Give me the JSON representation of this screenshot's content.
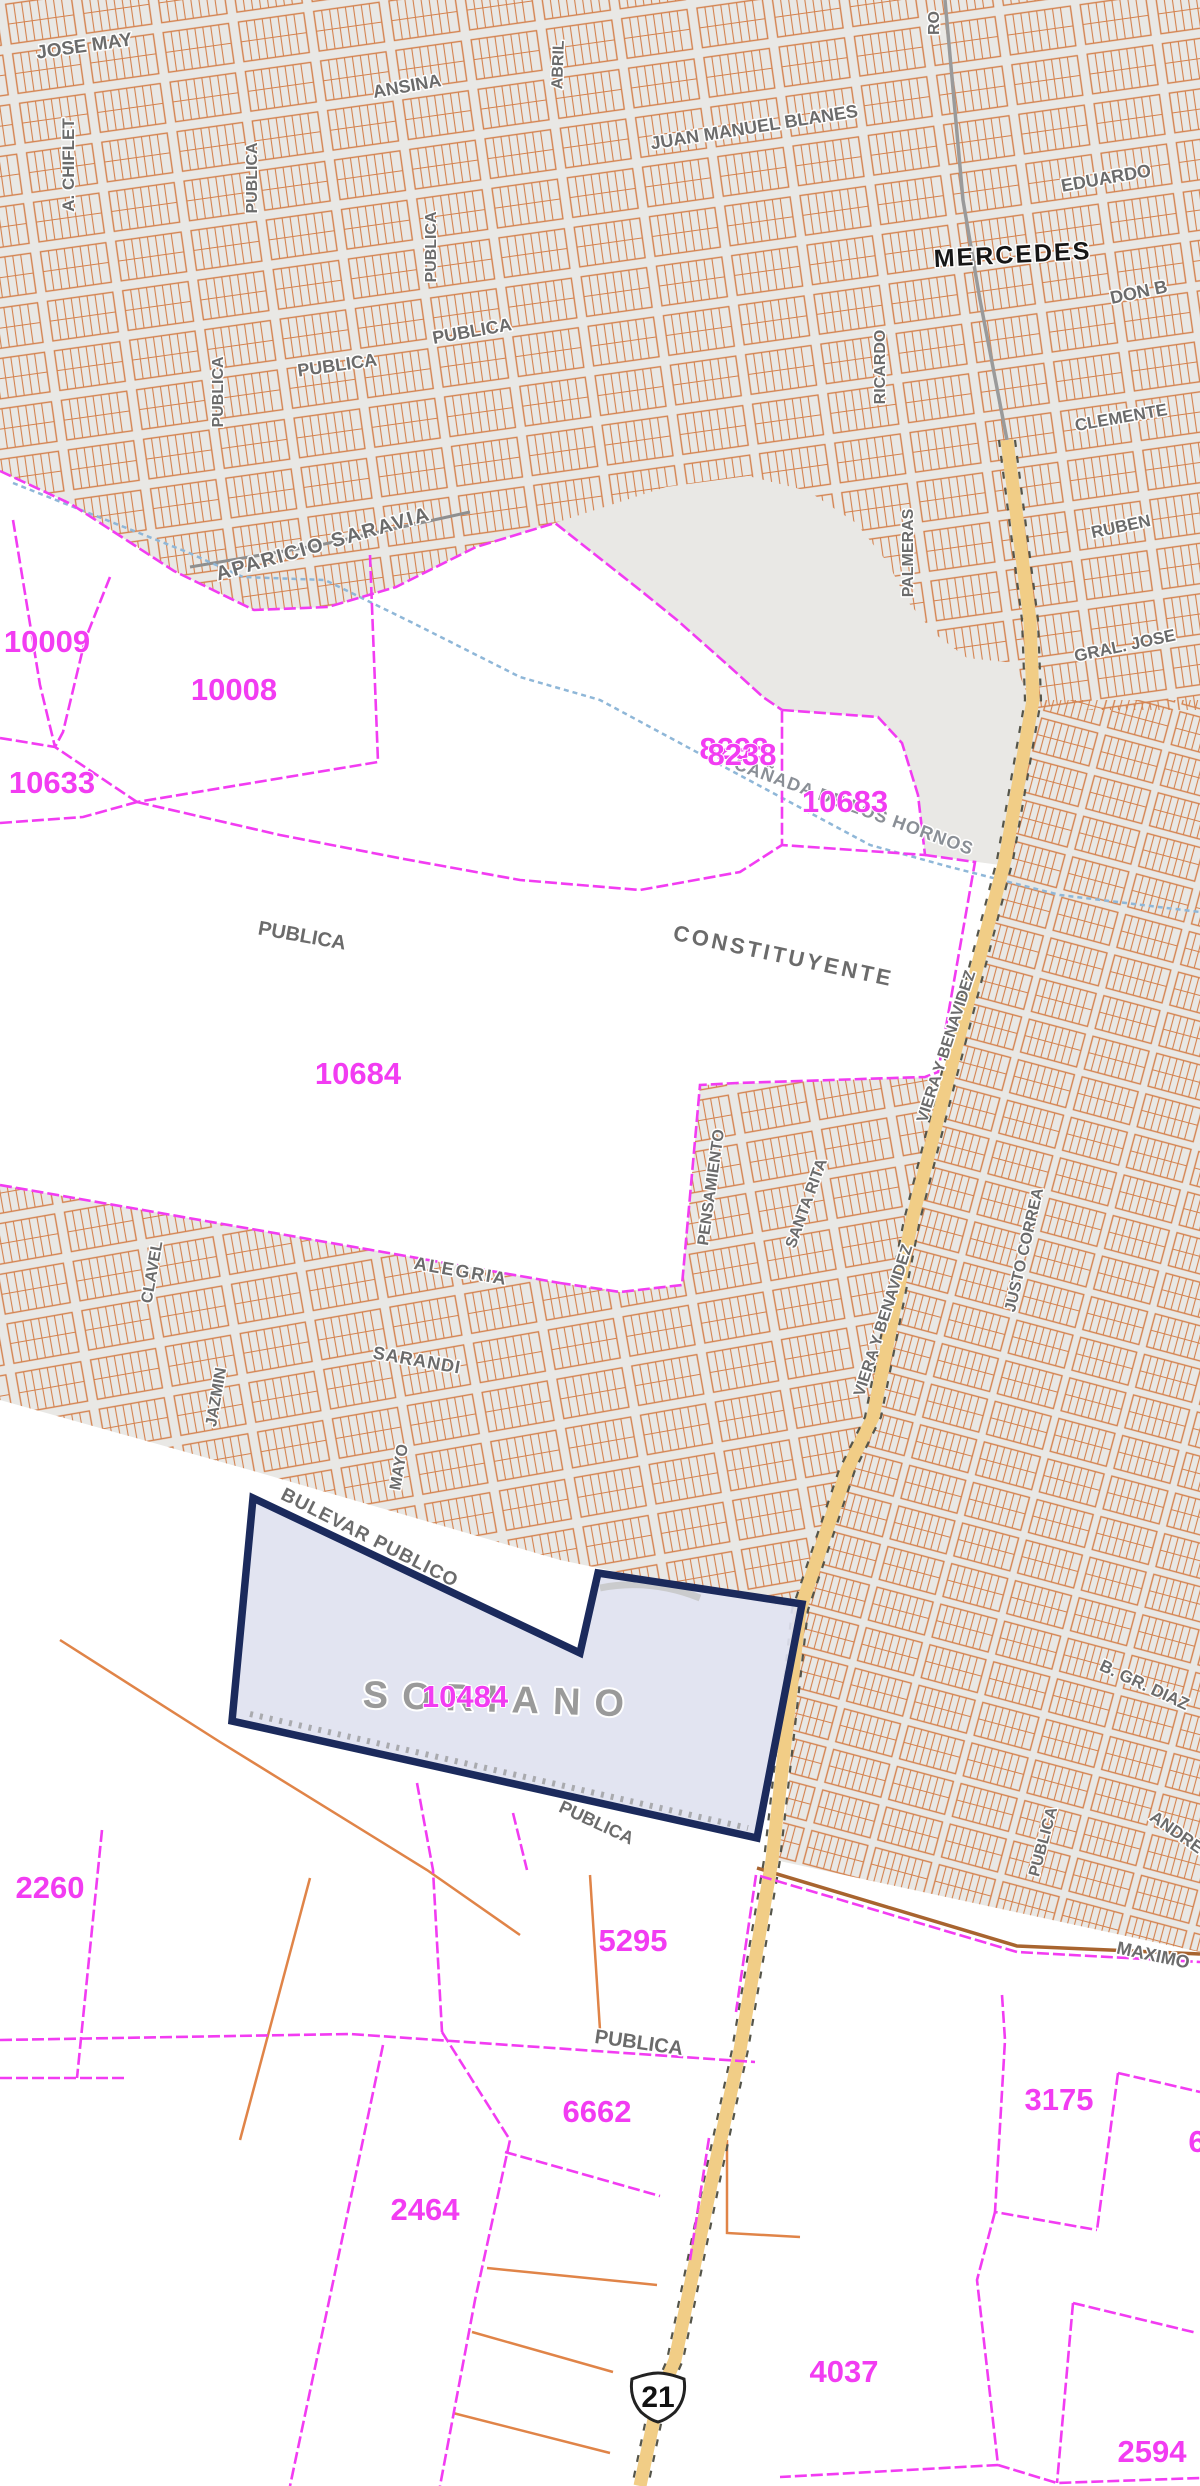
{
  "map": {
    "city_label": "MERCEDES",
    "department_label": "SORIANO",
    "stream_label": "CAÑADA DE LOS HORNOS",
    "route_shield": {
      "number": "21"
    },
    "street_labels": [
      {
        "text": "JOSE MAY"
      },
      {
        "text": "A. CHIFLET"
      },
      {
        "text": "ANSINA"
      },
      {
        "text": "ABRIL"
      },
      {
        "text": "JUAN MANUEL BLANES"
      },
      {
        "text": "PUBLICA"
      },
      {
        "text": "PUBLICA"
      },
      {
        "text": "PUBLICA"
      },
      {
        "text": "PUBLICA"
      },
      {
        "text": "PUBLICA"
      },
      {
        "text": "EDUARDO"
      },
      {
        "text": "DON B"
      },
      {
        "text": "RICARDO"
      },
      {
        "text": "CLEMENTE"
      },
      {
        "text": "RUBEN"
      },
      {
        "text": "GRAL. JOSE"
      },
      {
        "text": "PALMERAS"
      },
      {
        "text": "APARICIO SARAVIA"
      },
      {
        "text": "PUBLICA"
      },
      {
        "text": "CONSTITUYENTE"
      },
      {
        "text": "ALEGRIA"
      },
      {
        "text": "CLAVEL"
      },
      {
        "text": "SARANDI"
      },
      {
        "text": "JAZMIN"
      },
      {
        "text": "MAYO"
      },
      {
        "text": "PENSAMIENTO"
      },
      {
        "text": "SANTA RITA"
      },
      {
        "text": "VIERA Y BENAVIDEZ"
      },
      {
        "text": "VIERA Y BENAVIDEZ"
      },
      {
        "text": "JUSTO CORREA"
      },
      {
        "text": "B. GR. DIAZ"
      },
      {
        "text": "ANDRES"
      },
      {
        "text": "PUBLICA"
      },
      {
        "text": "BULEVAR PUBLICO"
      },
      {
        "text": "PUBLICA"
      },
      {
        "text": "PUBLICA"
      },
      {
        "text": "MAXIMO"
      },
      {
        "text": "RO"
      }
    ],
    "parcel_numbers": [
      {
        "text": "10009"
      },
      {
        "text": "10008"
      },
      {
        "text": "10633"
      },
      {
        "text": "8298"
      },
      {
        "text": "8238"
      },
      {
        "text": "10683"
      },
      {
        "text": "10684"
      },
      {
        "text": "10484"
      },
      {
        "text": "2260"
      },
      {
        "text": "5295"
      },
      {
        "text": "6662"
      },
      {
        "text": "2464"
      },
      {
        "text": "3175"
      },
      {
        "text": "4037"
      },
      {
        "text": "2594"
      },
      {
        "text": "6"
      }
    ],
    "colors": {
      "urban_fill": "#e9e8e5",
      "block_line": "#d4824e",
      "parcel_line": "#f23cf2",
      "highlight_stroke": "#1b2a5c",
      "highlight_fill": "#dfe2f0",
      "road_fill": "#f1cd86",
      "stream": "#8fb7d8",
      "street_label": "#6b6b6b",
      "city_label": "#161616"
    }
  }
}
